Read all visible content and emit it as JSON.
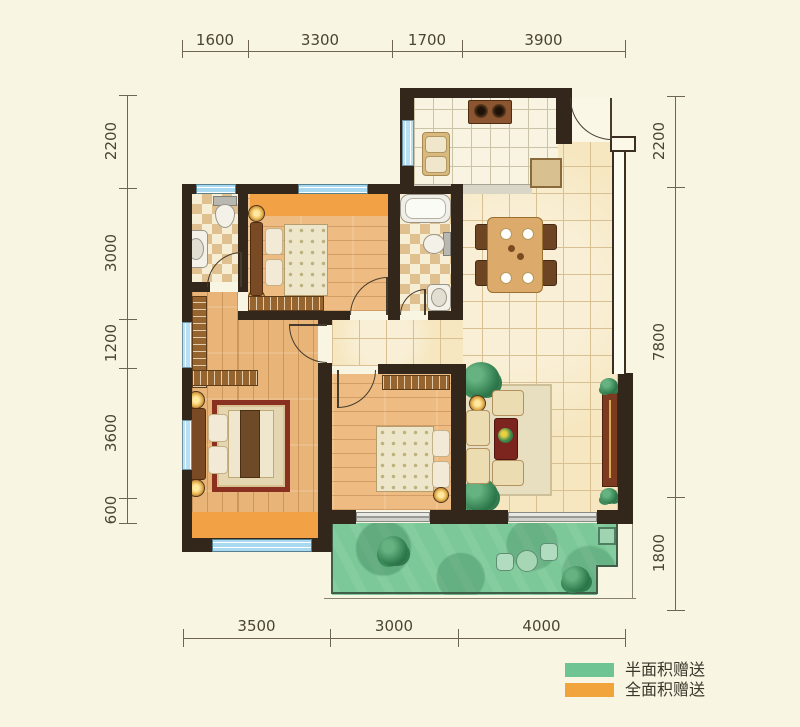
{
  "plan": {
    "type": "residential-floor-plan",
    "units": "mm"
  },
  "dimensions": {
    "top": [
      "1600",
      "3300",
      "1700",
      "3900"
    ],
    "left": [
      "2200",
      "3000",
      "1200",
      "3600",
      "600"
    ],
    "right": [
      "2200",
      "7800",
      "1800"
    ],
    "bottom": [
      "3500",
      "3000",
      "4000"
    ]
  },
  "legend": {
    "items": [
      {
        "label": "半面积赠送",
        "color": "#6fc493"
      },
      {
        "label": "全面积赠送",
        "color": "#f2a43c"
      }
    ]
  },
  "palette": {
    "background": "#f8f5e3",
    "wall": "#33261a",
    "window": "#a9d9f0",
    "wood_floor": "#e8b478",
    "tile_floor": "#f6e7c0",
    "checker_floor": "#dfc08e",
    "full_gift_orange": "#f2a144",
    "half_gift_green": "#7cc898",
    "dimension_text": "#4b4434"
  }
}
